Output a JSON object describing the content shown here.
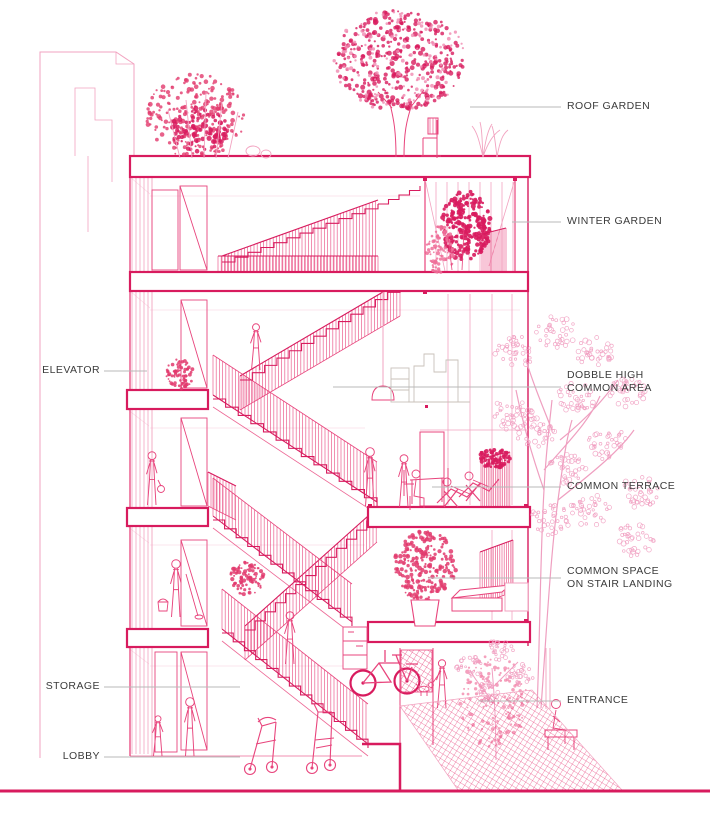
{
  "title": "Residential building section perspective diagram",
  "colors": {
    "accent_pink": "#d81b5e",
    "line_pink": "#e8447c",
    "light_pink": "#f2a3c0",
    "label_gray": "#3b3b3b",
    "leader_gray": "#b8b8b8"
  },
  "labels": {
    "roof_garden": "ROOF GARDEN",
    "winter_garden": "WINTER GARDEN",
    "elevator": "ELEVATOR",
    "dobble_high_common_area": "DOBBLE HIGH\nCOMMON AREA",
    "common_terrace": "COMMON TERRACE",
    "common_space_on_stair_landing": "COMMON SPACE\nON STAIR LANDING",
    "storage": "STORAGE",
    "entrance": "ENTRANCE",
    "lobby": "LOBBY"
  }
}
